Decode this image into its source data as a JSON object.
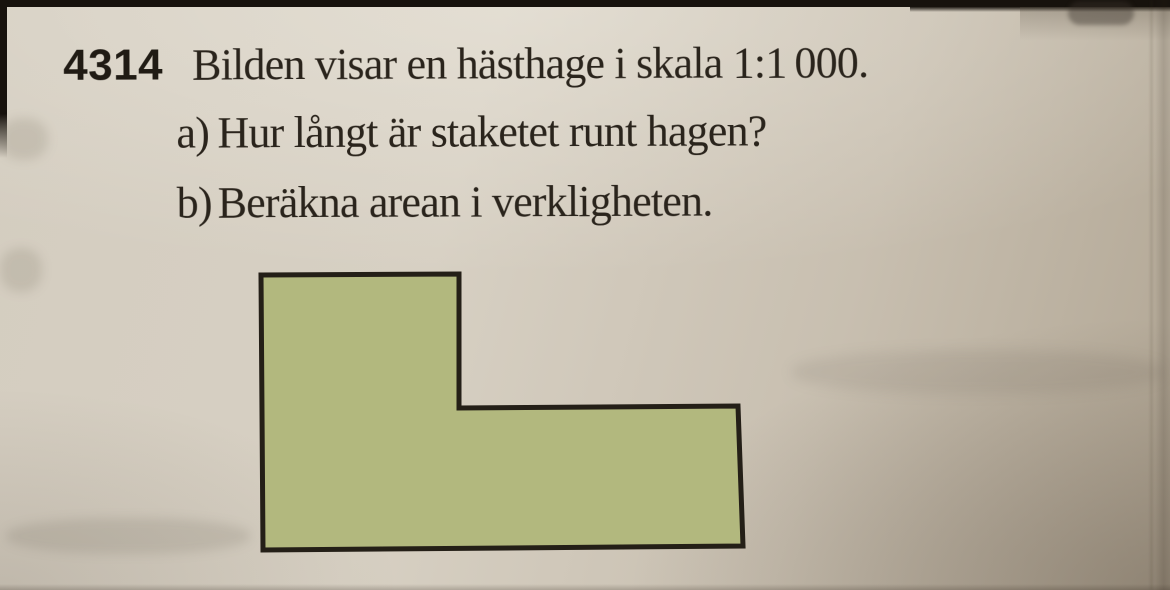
{
  "page": {
    "paper_color": "#d2cbbd",
    "ink_color": "#2a241c"
  },
  "problem": {
    "number": "4314",
    "statement": "Bilden visar en hästhage i skala 1:1 000.",
    "parts": [
      {
        "label": "a)",
        "text": "Hur långt är staketet runt hagen?"
      },
      {
        "label": "b)",
        "text": "Beräkna arean i verkligheten."
      }
    ]
  },
  "figure": {
    "description": "L-shaped horse paddock drawn to scale",
    "fill_color": "#b2b87e",
    "outline_color": "#241f17",
    "points": "261,275 459,274 459,408 738,406 743,546 263,550"
  }
}
